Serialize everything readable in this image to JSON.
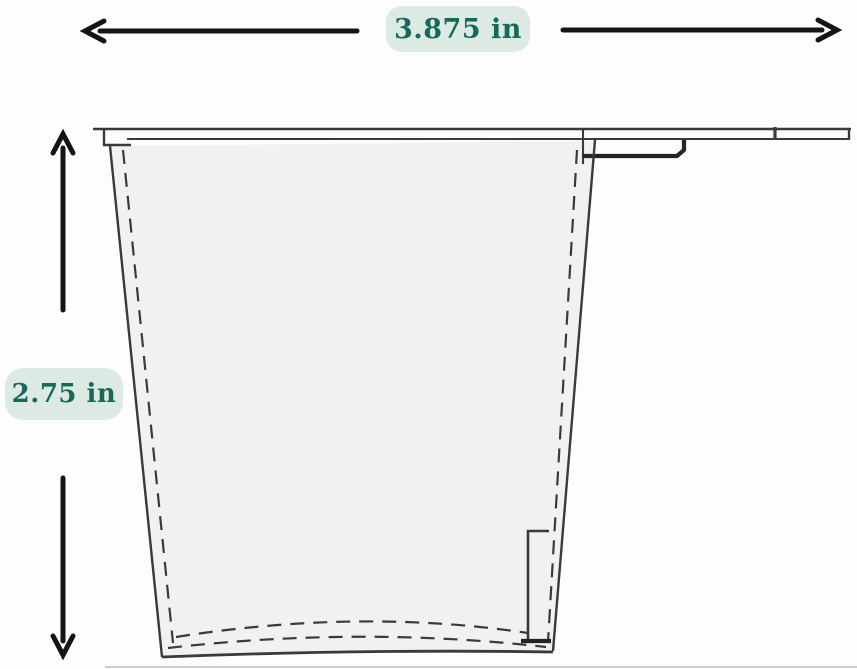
{
  "meta": {
    "title": "Cup cross-section dimension diagram"
  },
  "diagram": {
    "type": "technical-drawing",
    "subject": "tapered cup / inner pot cross-section with rim flange and side clip",
    "width_dimension": {
      "label": "3.875 in",
      "orientation": "horizontal"
    },
    "height_dimension": {
      "label": "2.75 in",
      "orientation": "vertical"
    },
    "icons": {
      "horizontal_arrow": "left-right-dimension-arrow",
      "vertical_arrow": "up-down-dimension-arrow"
    },
    "colors": {
      "page_bg": "#fdfdfd",
      "label_bg": "#dceae3",
      "label_text": "#17695a",
      "arrow": "#141414",
      "line": "#3a3a3a",
      "line_dark": "#242424",
      "cup_fill": "#f1f2f0"
    }
  }
}
